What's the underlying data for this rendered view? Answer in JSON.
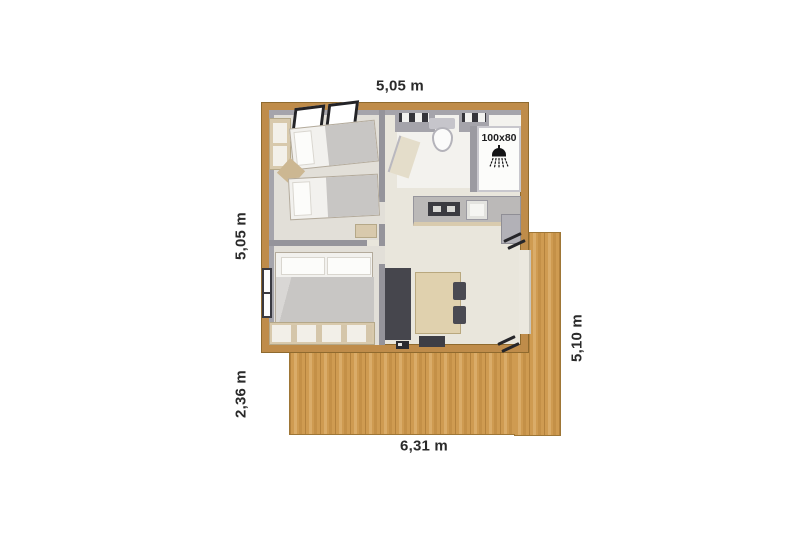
{
  "canvas": {
    "width": 800,
    "height": 533,
    "background": "#ffffff"
  },
  "dimension_labels": {
    "top": "5,05 m",
    "left_upper": "5,05 m",
    "left_lower": "2,36 m",
    "bottom": "6,31 m",
    "right": "5,10 m"
  },
  "shower": {
    "size_label": "100x80",
    "icon": "shower-icon"
  },
  "colors": {
    "outer_wall_wood": "#bf8c4a",
    "deck_wood": "#cf9b51",
    "interior_floor": "#e9e6dc",
    "bathroom_floor": "#f3f2ee",
    "interior_wall_gray": "#9b9aa1",
    "furniture_beige": "#d8c9ac",
    "bed_blanket_gray": "#c8c6c4",
    "furniture_dark": "#46464d",
    "label_text": "#2a2a2a"
  }
}
